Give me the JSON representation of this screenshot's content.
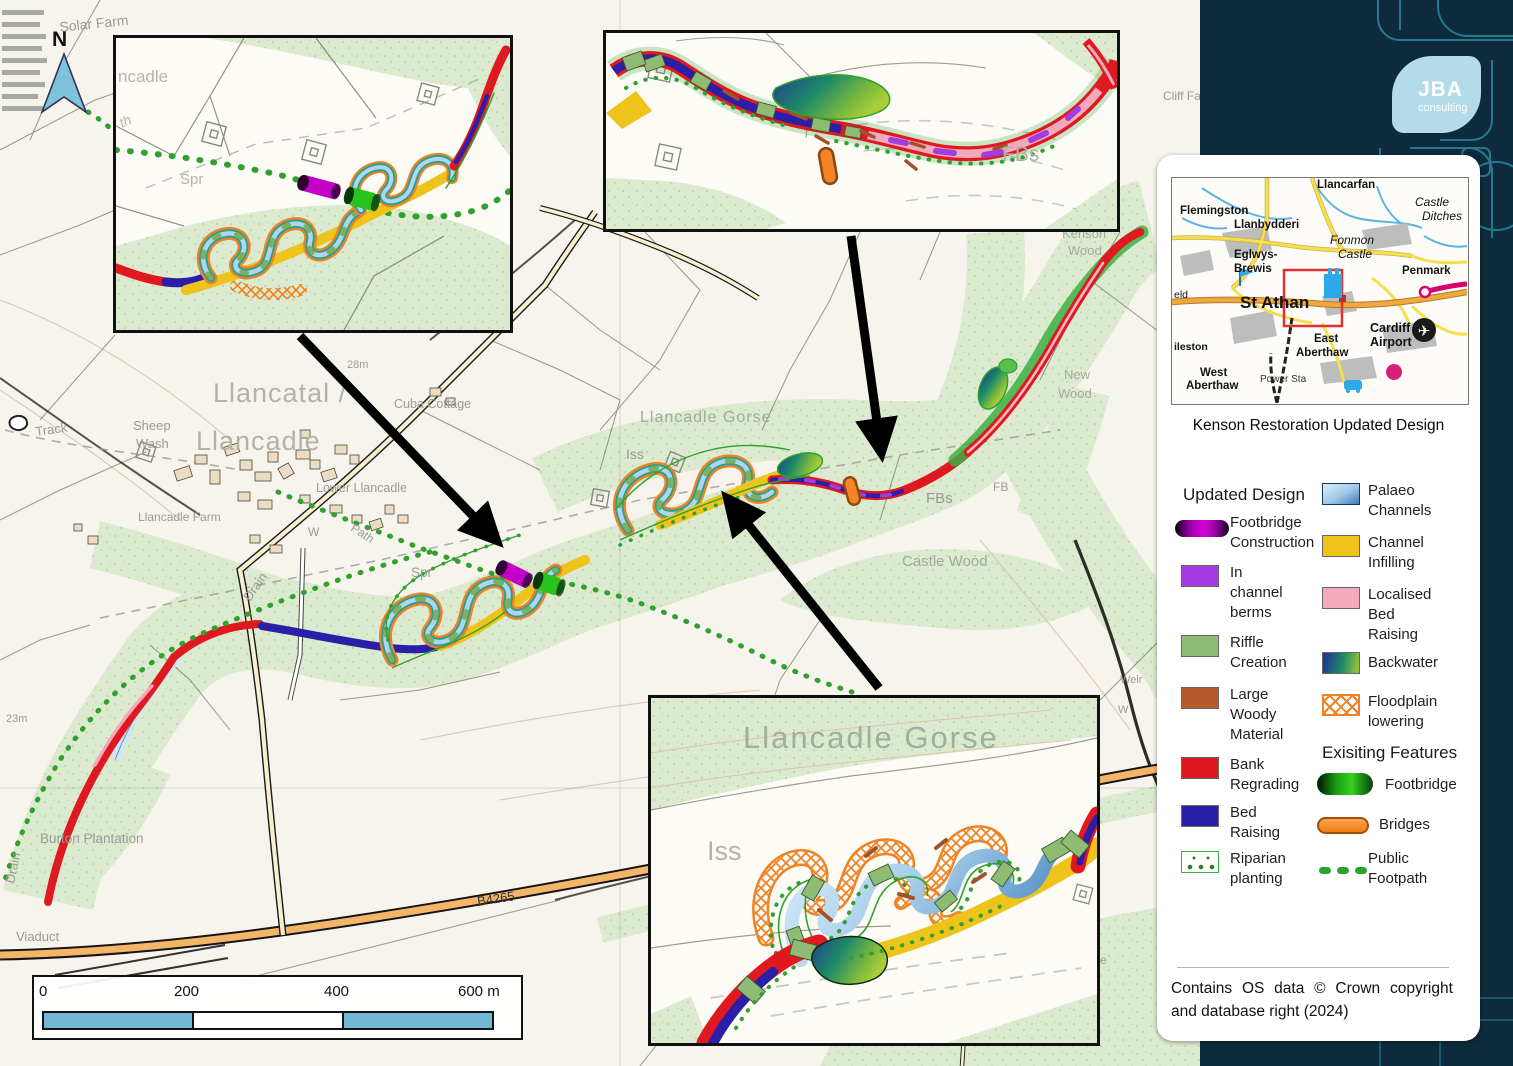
{
  "logo": {
    "name": "JBA",
    "tagline": "consulting"
  },
  "panel": {
    "title": "Kenson Restoration Updated Design",
    "copyright_line1": "Contains OS data © Crown copyright",
    "copyright_line2": "and database right (2024)"
  },
  "location_map": {
    "flemingston": "Flemingston",
    "llanbydderi": "Llanbydderi",
    "llancarfan": "Llancarfan",
    "castle_ditches_1": "Castle",
    "castle_ditches_2": "Ditches",
    "fonmon_1": "Fonmon",
    "fonmon_2": "Castle",
    "eglwys_1": "Eglwys-",
    "eglwys_2": "Brewis",
    "penmark": "Penmark",
    "eld": "eld",
    "st_athan": "St Athan",
    "cardiff_1": "Cardiff",
    "cardiff_2": "Airport",
    "east_1": "East",
    "east_2": "Aberthaw",
    "ileston": "ileston",
    "west_1": "West",
    "west_2": "Aberthaw",
    "power_sta": "Power Sta"
  },
  "legend": {
    "header_updated": "Updated Design",
    "header_existing": "Exisiting Features",
    "updated": [
      {
        "label_lines": [
          "Footbridge",
          "Construction"
        ]
      },
      {
        "label_lines": [
          "In",
          "channel",
          "berms"
        ]
      },
      {
        "label_lines": [
          "Riffle",
          "Creation"
        ]
      },
      {
        "label_lines": [
          "Large",
          "Woody",
          "Material"
        ]
      },
      {
        "label_lines": [
          "Bank",
          "Regrading"
        ]
      },
      {
        "label_lines": [
          "Bed",
          "Raising"
        ]
      },
      {
        "label_lines": [
          "Riparian",
          "planting"
        ]
      },
      {
        "label_lines": [
          "Palaeo",
          "Channels"
        ]
      },
      {
        "label_lines": [
          "Channel",
          "Infilling"
        ]
      },
      {
        "label_lines": [
          "Localised",
          "Bed",
          "Raising"
        ]
      },
      {
        "label_lines": [
          "Backwater"
        ]
      },
      {
        "label_lines": [
          "Floodplain",
          "lowering"
        ]
      }
    ],
    "existing": [
      {
        "label_lines": [
          "Footbridge"
        ]
      },
      {
        "label_lines": [
          "Bridges"
        ]
      },
      {
        "label_lines": [
          "Public",
          "Footpath"
        ]
      }
    ]
  },
  "scalebar": {
    "t0": "0",
    "t200": "200",
    "t400": "400",
    "t600": "600 m"
  },
  "north_label": "N",
  "map_labels": {
    "solar_farm": "Solar Farm",
    "track": "Track",
    "llancatal_1": "Llancatal /",
    "llancatal_2": "Llancadle",
    "sheep_1": "Sheep",
    "sheep_2": "Wash",
    "cuba_cottage": "Cuba Cottage",
    "lower_llancadle": "Lower Llancadle",
    "llancadle_farm": "Llancadle Farm",
    "m28": "28m",
    "m23": "23m",
    "path": "Path",
    "w_village": "W",
    "spr": "Spr",
    "drain_1": "Drain",
    "drain_2": "Drain",
    "burton": "Burton Plantation",
    "viaduct": "Viaduct",
    "b4265": "B4265",
    "gorse_main": "Llancadle Gorse",
    "iss_main": "Iss",
    "fbs_main": "FBs",
    "fb_main": "FB",
    "castle_wood": "Castle Wood",
    "kenson_1": "Kenson",
    "kenson_2": "Wood",
    "new_1": "New",
    "new_2": "Wood",
    "cliff": "Cliff Fa",
    "weir": "Weir",
    "w_weir": "W",
    "odge": "odge"
  },
  "inset_labels": {
    "left_ncadle": "ncadle",
    "left_th": "th",
    "left_spr": "Spr",
    "middle_fbs": "FBs",
    "bottom_gorse": "Llancadle Gorse",
    "bottom_iss": "Iss"
  },
  "colors": {
    "sidebar_navy": "#0d2b3c",
    "accent_teal": "#2e93a8",
    "badge_blue": "#b3dbe9",
    "bank_regrading_red": "#e0181f",
    "bed_raising_blue": "#2b1fa8",
    "in_channel_berms_purple": "#a33ce0",
    "riffle_green": "#8fbb72",
    "large_woody_brown": "#b65c2a",
    "channel_infilling_yellow": "#eec41a",
    "localised_bed_raising_pink": "#f2a9bb",
    "floodplain_orange": "#f08221",
    "footpath_green": "#2fa12c",
    "scalebar_blue": "#72b7d3",
    "woodland_green": "#dcead0"
  }
}
